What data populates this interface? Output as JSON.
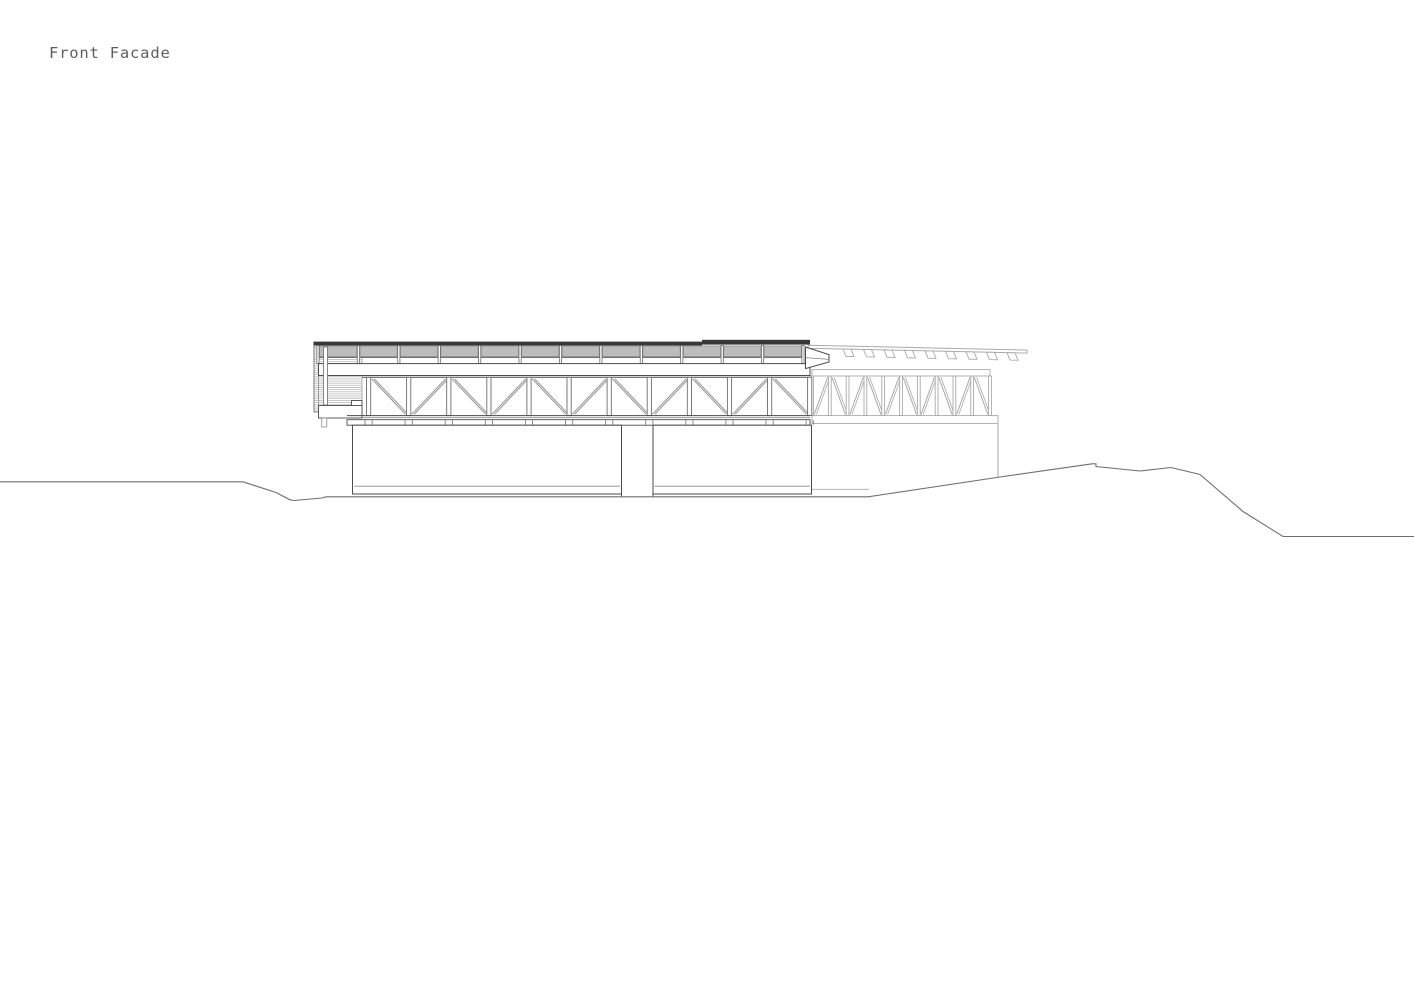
{
  "title": "Front Facade",
  "drawing": {
    "type": "architectural-elevation",
    "colors": {
      "line_dark": "#4a4a4a",
      "line_mid": "#7d7d7d",
      "line_light": "#a9a9a9",
      "roof_fill": "#383838",
      "panel_fill": "#bcbcbc",
      "panel_edge": "#8a8a8a",
      "hatch_line": "#c0c0c0",
      "terrain_line": "#6f6f6f",
      "paper": "#ffffff",
      "title_color": "#5f5f5f"
    },
    "front_wing": {
      "clerestory_bays": 12,
      "truss_panels": 11,
      "podium_walls": 2
    },
    "rear_wing": {
      "truss_panels": 10,
      "rafter_tails": 9
    }
  }
}
